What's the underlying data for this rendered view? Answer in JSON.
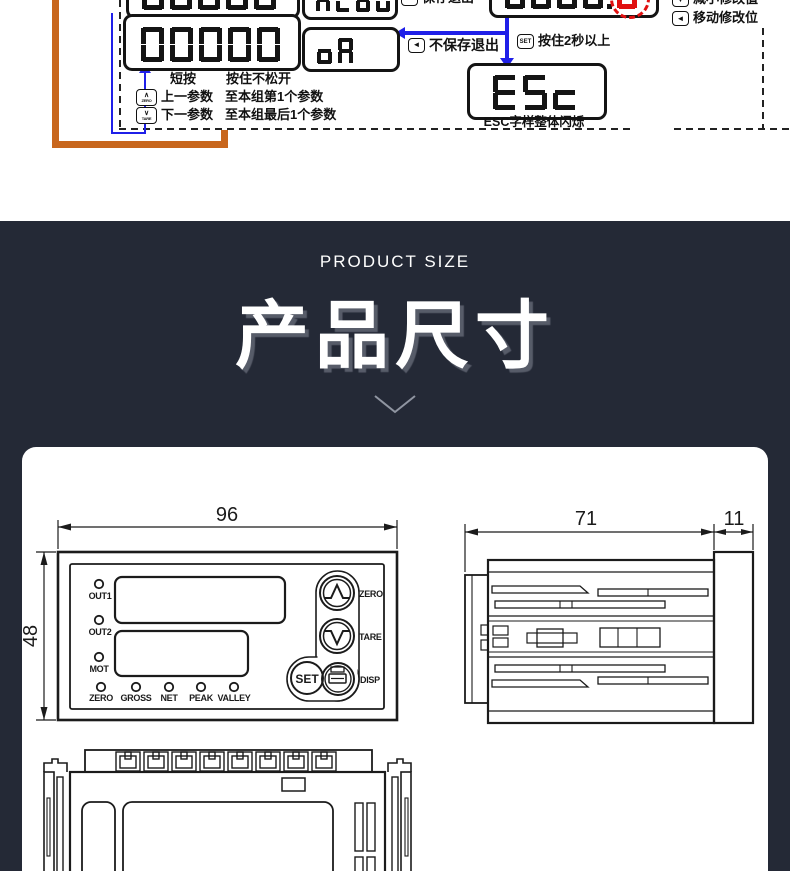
{
  "diagram": {
    "displays": {
      "prev_value": "00000",
      "prev_param": "ALoU",
      "value": "00000",
      "param": "oA",
      "edit_digits": "0000.",
      "edit_blink_digit": "0",
      "esc": "ESc"
    },
    "keys": {
      "set": "SET",
      "left": "◄",
      "down": "▼",
      "up_chevron": "∧",
      "down_chevron": "∨",
      "zero_text": "ZERO",
      "tare_text": "TARE"
    },
    "labels": {
      "save_exit": "保存退出",
      "no_save_exit": "不保存退出",
      "hold_2s": "按住2秒以上",
      "esc_blink": "ESC字样整体闪烁",
      "decrease_value": "减小修改值",
      "move_digit": "移动修改位",
      "short_press": "短按",
      "hold_press": "按住不松开",
      "prev_param": "上一参数",
      "prev_param_to": "至本组第1个参数",
      "next_param": "下一参数",
      "next_param_to": "至本组最后1个参数"
    }
  },
  "banner": {
    "subtitle": "PRODUCT SIZE",
    "title": "产品尺寸"
  },
  "drawings": {
    "front": {
      "width": "96",
      "height": "48",
      "leds_left": [
        "OUT1",
        "OUT2",
        "MOT"
      ],
      "leds_bottom": [
        "ZERO",
        "GROSS",
        "NET",
        "PEAK",
        "VALLEY"
      ],
      "btn_zero": "ZERO",
      "btn_tare": "TARE",
      "btn_set": "SET",
      "btn_disp": "DISP"
    },
    "side": {
      "depth": "71",
      "bezel": "11"
    }
  },
  "colors": {
    "banner_bg": "#242936",
    "accent_orange": "#c8661d",
    "flow_blue": "#1f1fe8",
    "blink_red": "#e01010",
    "line_black": "#1b1b1b"
  }
}
